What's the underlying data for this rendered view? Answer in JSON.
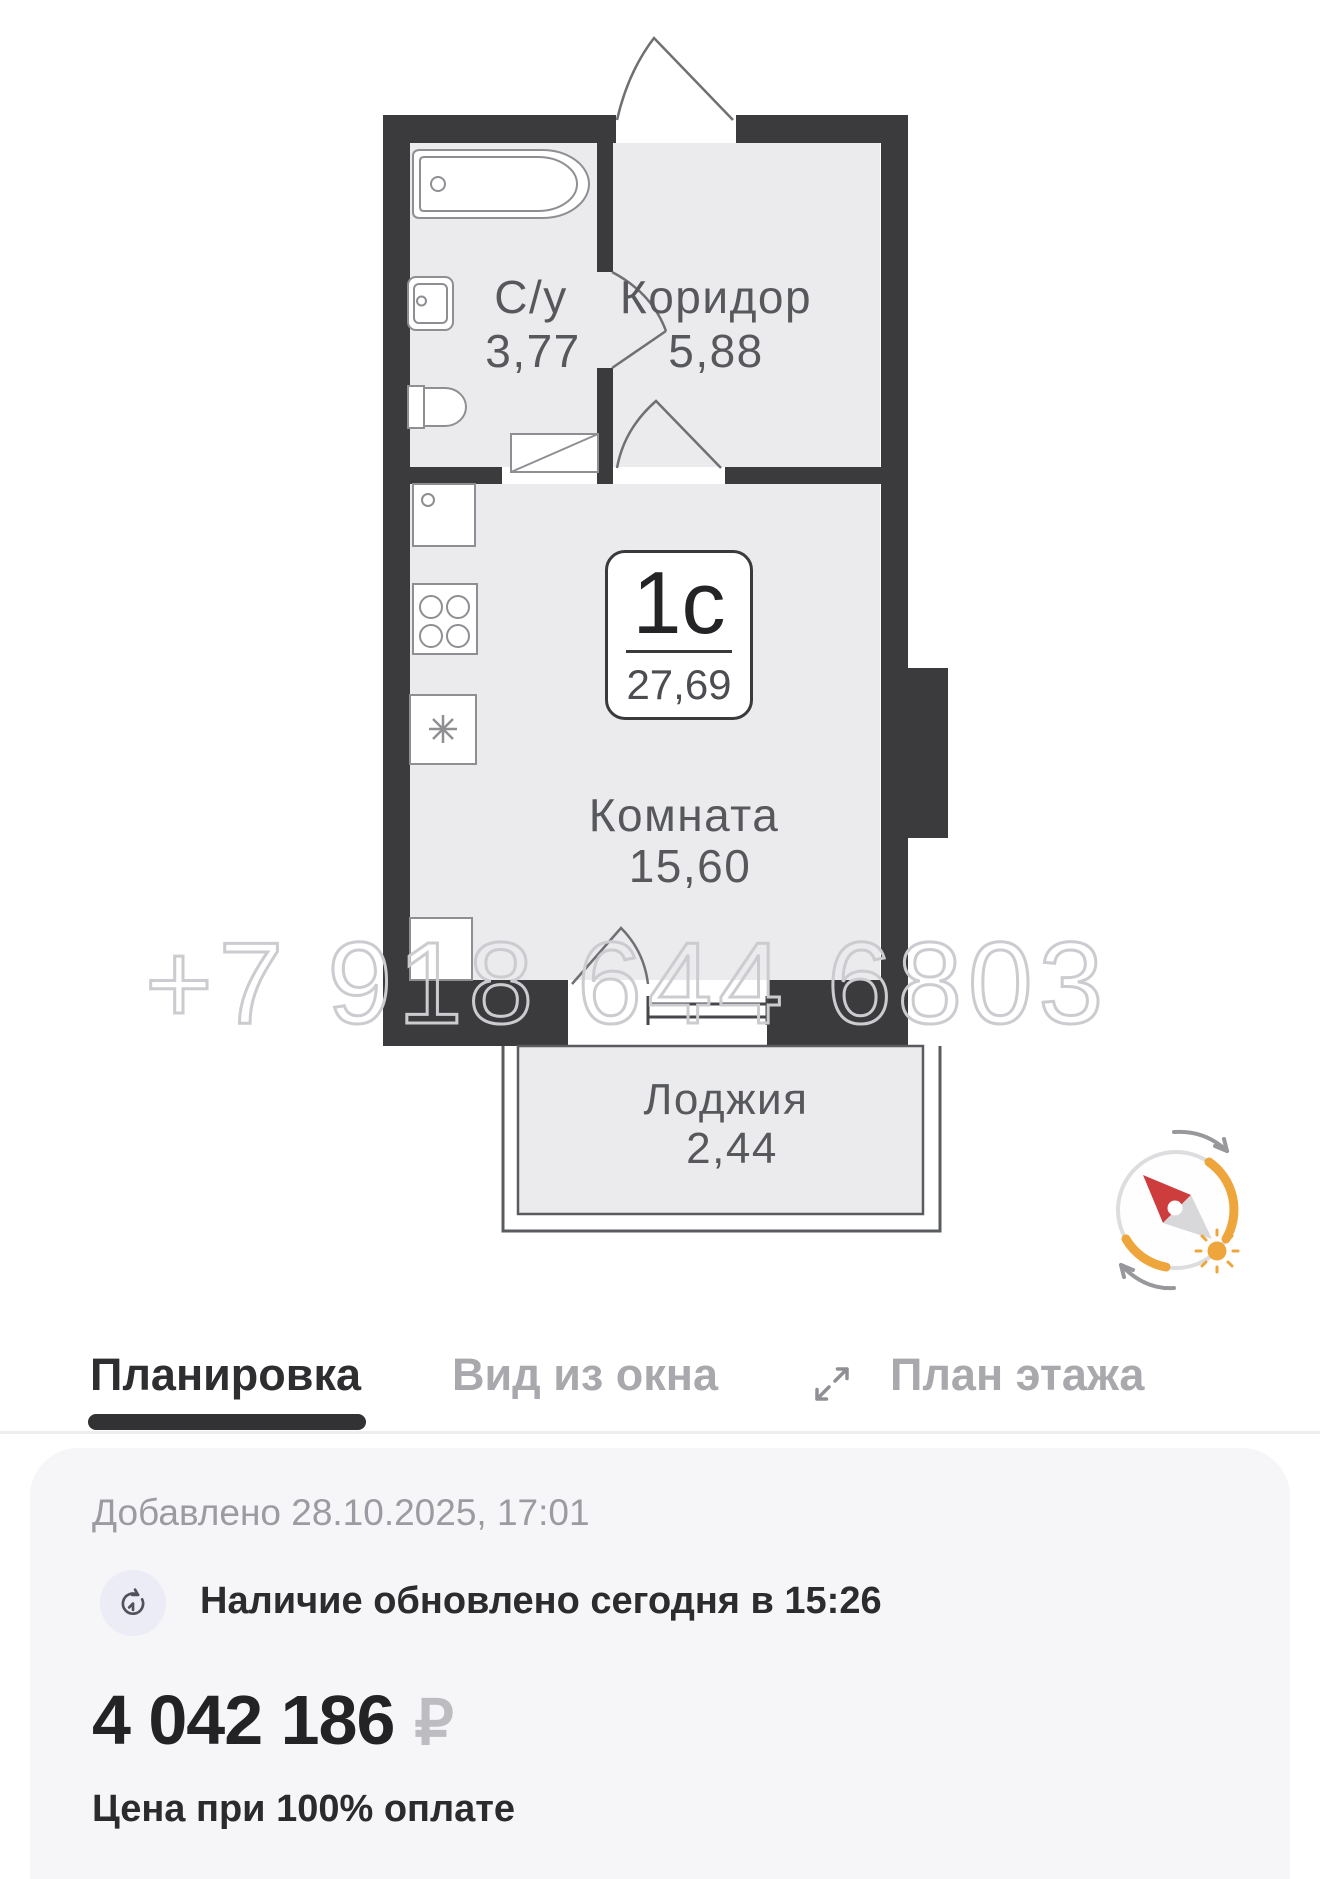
{
  "floor_plan": {
    "unit_badge": {
      "type": "1с",
      "area": "27,69"
    },
    "rooms": {
      "bathroom": {
        "name": "С/у",
        "area": "3,77"
      },
      "corridor": {
        "name": "Коридор",
        "area": "5,88"
      },
      "living": {
        "name": "Комната",
        "area": "15,60"
      },
      "loggia": {
        "name": "Лоджия",
        "area": "2,44"
      }
    },
    "watermark": "+7 918 644 6803"
  },
  "tabs": [
    {
      "label": "Планировка",
      "active": true
    },
    {
      "label": "Вид из окна",
      "active": false
    },
    {
      "label": "План этажа",
      "active": false
    }
  ],
  "icons": {
    "expand": "diagonal-expand-arrows",
    "clock": "history-clock",
    "compass": "sun-direction-compass",
    "currency": "ruble-sign"
  },
  "card": {
    "added": "Добавлено 28.10.2025, 17:01",
    "availability": "Наличие обновлено сегодня в 15:26",
    "price": "4 042 186",
    "currency": "₽",
    "price_note": "Цена при 100% оплате"
  },
  "colors": {
    "wall": "#3b3b3d",
    "room_fill": "#ebebed",
    "plan_label": "#57585c",
    "watermark_outline": "#ccccd0",
    "tab_active": "#2e2e30",
    "tab_inactive": "#a9a9ad",
    "card_bg": "#f6f6f8",
    "muted_text": "#9b9ba1",
    "price_text": "#232325",
    "ruble_gray": "#bcbcc1",
    "accent_orange": "#eea63c",
    "needle_red": "#cd3d3d"
  }
}
